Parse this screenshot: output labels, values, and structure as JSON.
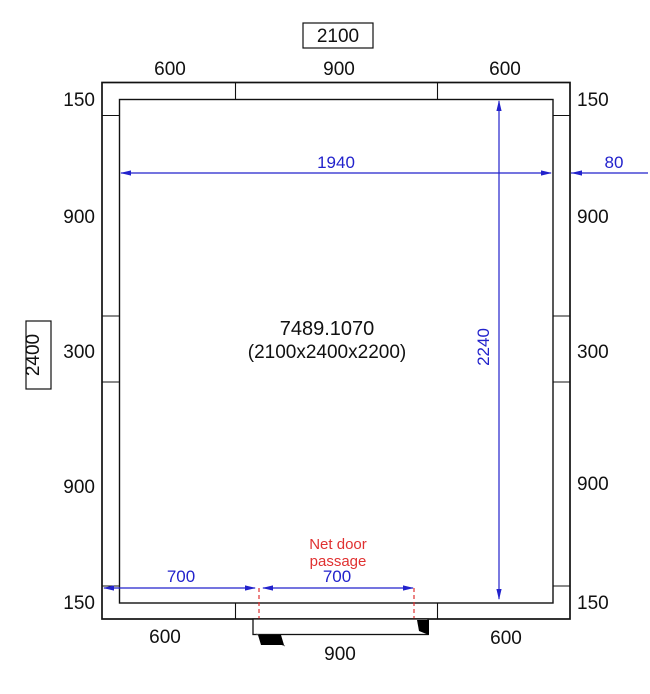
{
  "drawing": {
    "overall_width_label": "2100",
    "overall_height_label": "2400",
    "room": {
      "code": "7489.1070",
      "size": "(2100x2400x2200)"
    },
    "top_panel_dims": [
      "600",
      "900",
      "600"
    ],
    "bottom_panel_dims": [
      "600",
      "900",
      "600"
    ],
    "left_panel_dims": [
      "150",
      "900",
      "300",
      "900",
      "150"
    ],
    "right_panel_dims": [
      "150",
      "900",
      "300",
      "900",
      "150"
    ],
    "blue_dims": {
      "inner_width": "1940",
      "wall_thickness": "80",
      "inner_height": "2240",
      "door_left_offset": "700",
      "door_passage": "700"
    },
    "door_note_line1": "Net door",
    "door_note_line2": "passage",
    "colors": {
      "dimension_blue": "#2222cc",
      "door_note_red": "#e03131",
      "line_black": "#111111",
      "background": "#ffffff"
    }
  }
}
